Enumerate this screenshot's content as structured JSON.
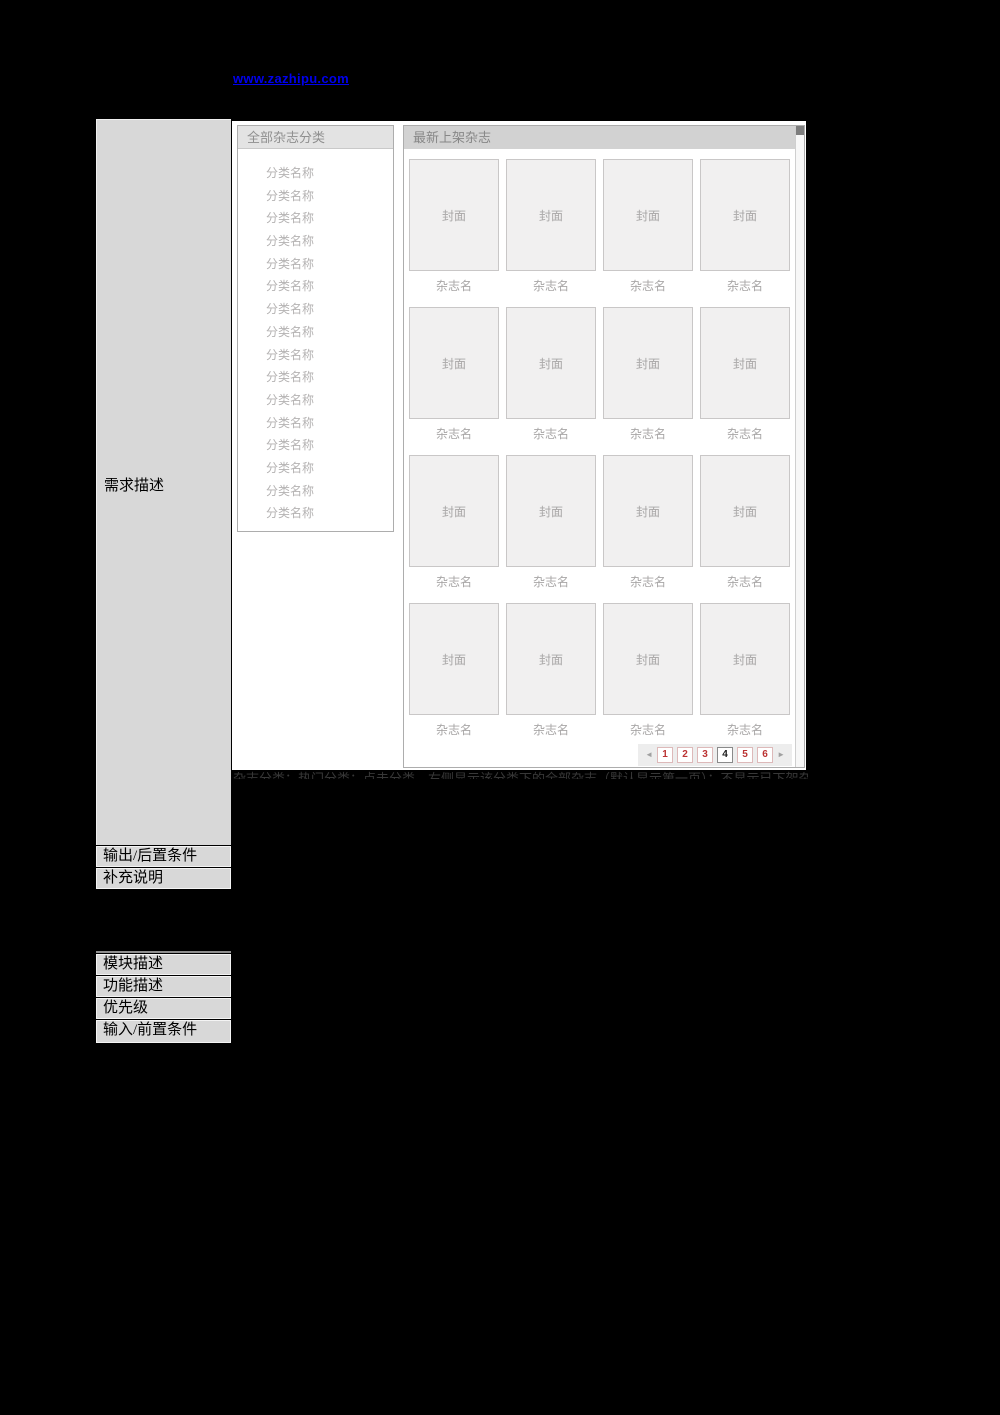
{
  "link": {
    "text": "www.zazhipu.com"
  },
  "doc": {
    "requirement_label": "需求描述",
    "requirement_note": "杂志分类：热门分类；点击分类，右侧显示该分类下的全部杂志（默认显示第一页）；不显示已下架杂志",
    "output_row": "输出/后置条件",
    "notes_row": "补充说明",
    "module_row": "模块描述",
    "function_row": "功能描述",
    "priority_row": "优先级",
    "input_row": "输入/前置条件"
  },
  "wireframe": {
    "left_panel": {
      "title": "全部杂志分类",
      "items": [
        "分类名称",
        "分类名称",
        "分类名称",
        "分类名称",
        "分类名称",
        "分类名称",
        "分类名称",
        "分类名称",
        "分类名称",
        "分类名称",
        "分类名称",
        "分类名称",
        "分类名称",
        "分类名称",
        "分类名称",
        "分类名称"
      ]
    },
    "right_panel": {
      "title": "最新上架杂志",
      "cover_label": "封面",
      "name_label": "杂志名",
      "grid": {
        "rows": 4,
        "cols": 4
      },
      "pagination": {
        "prev": "◄",
        "pages": [
          "1",
          "2",
          "3",
          "4",
          "5",
          "6"
        ],
        "current_page": "4",
        "next": "►"
      }
    }
  },
  "colors": {
    "link": "#0000ee",
    "page_number": "#bb3333",
    "current_page_text": "#1a1a1a",
    "left_column_bg": "#d8d8d8",
    "right_header_bg": "#d2d2d2",
    "left_header_bg": "#e3e3e3",
    "cover_bg": "#f1f0f0"
  }
}
